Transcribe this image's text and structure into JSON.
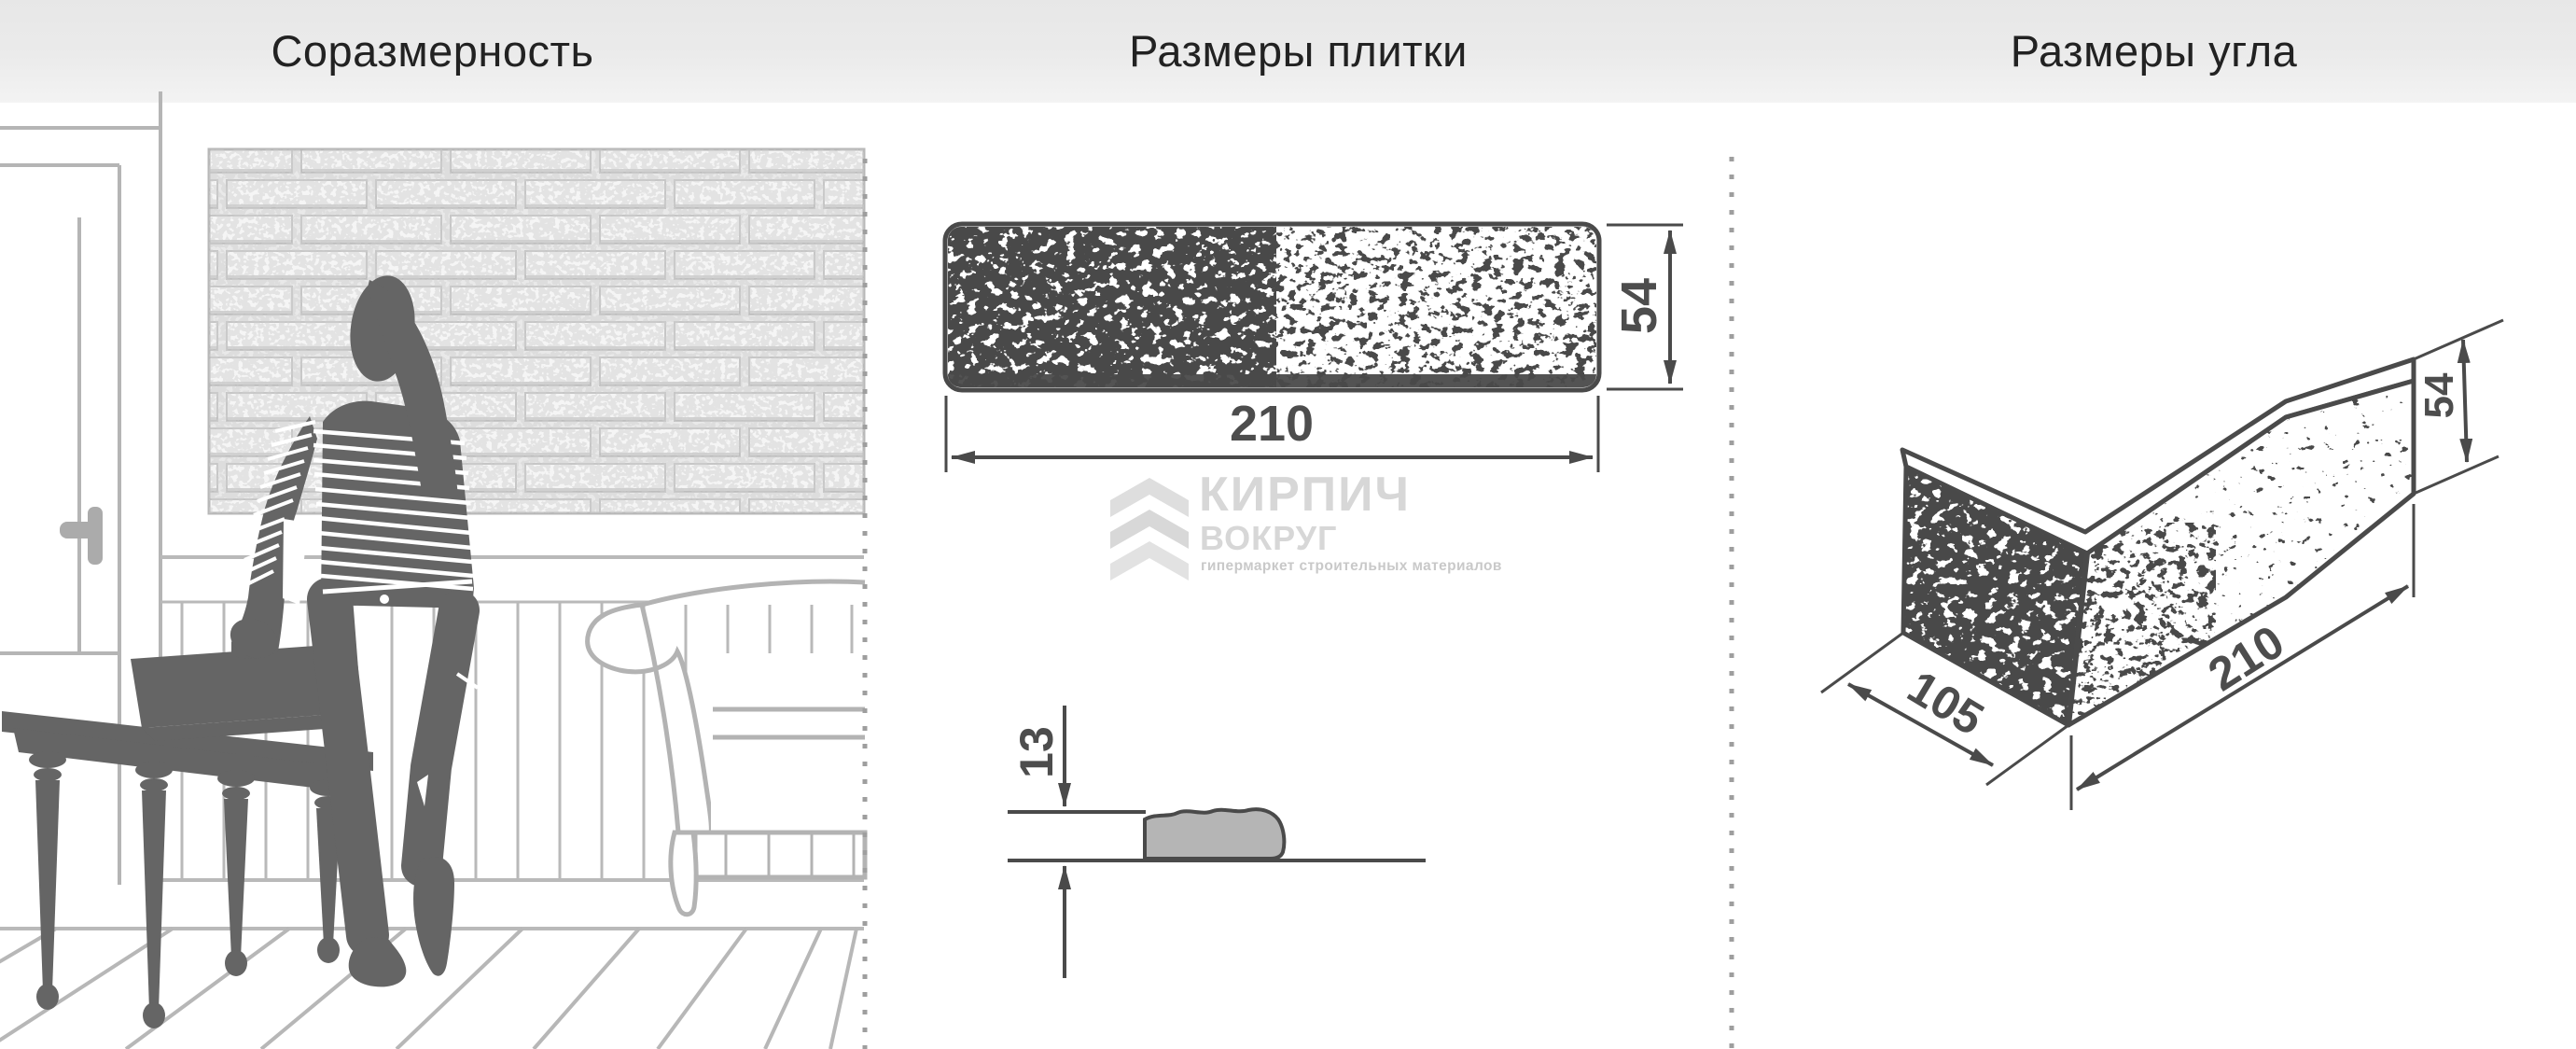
{
  "header": {
    "titles": [
      "Соразмерность",
      "Размеры плитки",
      "Размеры угла"
    ]
  },
  "tile": {
    "width": "210",
    "height": "54",
    "thickness": "13"
  },
  "corner": {
    "depth": "105",
    "length": "210",
    "height": "54"
  },
  "watermark": {
    "line1": "КИРПИЧ",
    "line2": "ВОКРУГ",
    "tagline": "гипермаркет строительных материалов"
  },
  "colors": {
    "ink": "#4a4a4a",
    "dim_text": "#4d4d4d",
    "silhouette": "#656565",
    "lineart": "#b5b5b5",
    "divider_dots": "#9e9e9e",
    "header_text": "#222222",
    "watermark_text": "#d7d7d7",
    "watermark_tagline": "#c9c9c9",
    "profile_slab_fill": "#b5b5b5"
  }
}
